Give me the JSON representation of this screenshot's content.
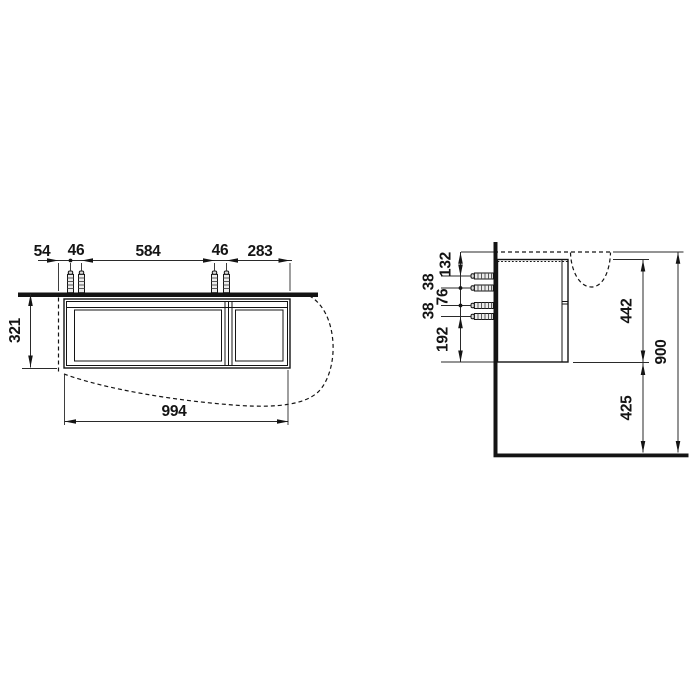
{
  "drawing": {
    "kind": "vanity-unit-technical-drawing",
    "background": "#ffffff",
    "line_color": "#141414",
    "front_view": {
      "top_dims": {
        "d1": "54",
        "d2": "46",
        "d3": "584",
        "d4": "46",
        "d5": "283"
      },
      "height_dim": "321",
      "width_dim": "994"
    },
    "side_view": {
      "left_dims": {
        "d1": "132",
        "d2": "38",
        "d3": "76",
        "d4": "38",
        "d5": "192"
      },
      "cabinet_height_dim": "442",
      "total_height_dim": "900",
      "floor_clearance_dim": "425"
    }
  }
}
